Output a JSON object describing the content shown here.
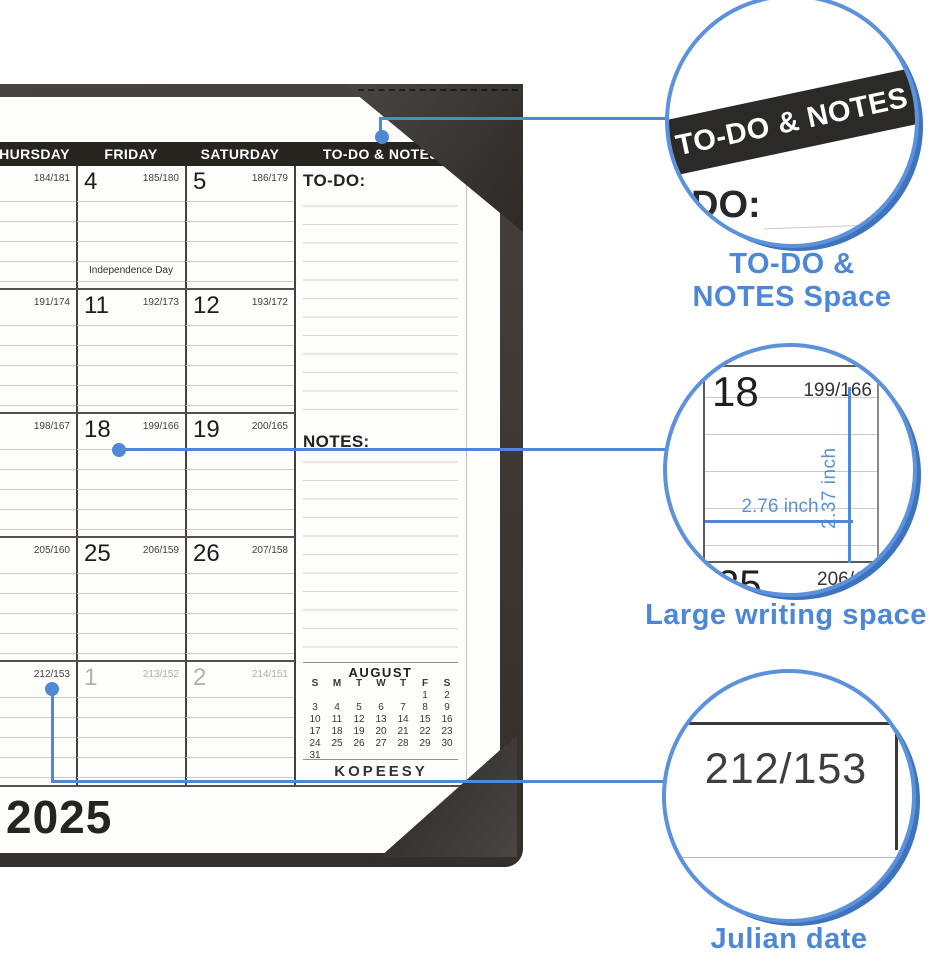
{
  "brand_calendar": {
    "weekdays": [
      "THURSDAY",
      "FRIDAY",
      "SATURDAY"
    ],
    "todo_col_header": "TO-DO & NOTES",
    "todo_label": "TO-DO:",
    "notes_label": "NOTES:",
    "holiday_note": "Independence Day",
    "rows": [
      {
        "thu_julian": "184/181",
        "fri_date": "4",
        "fri_julian": "185/180",
        "sat_date": "5",
        "sat_julian": "186/179"
      },
      {
        "thu_julian": "191/174",
        "fri_date": "11",
        "fri_julian": "192/173",
        "sat_date": "12",
        "sat_julian": "193/172"
      },
      {
        "thu_julian": "198/167",
        "fri_date": "18",
        "fri_julian": "199/166",
        "sat_date": "19",
        "sat_julian": "200/165"
      },
      {
        "thu_julian": "205/160",
        "fri_date": "25",
        "fri_julian": "206/159",
        "sat_date": "26",
        "sat_julian": "207/158"
      },
      {
        "thu_julian": "212/153",
        "fri_date": "1",
        "fri_julian": "213/152",
        "sat_date": "2",
        "sat_julian": "214/151"
      }
    ],
    "mini_month": {
      "title": "AUGUST",
      "day_headers": [
        "S",
        "M",
        "T",
        "W",
        "T",
        "F",
        "S"
      ],
      "weeks": [
        [
          "",
          "",
          "",
          "",
          "",
          "1",
          "2"
        ],
        [
          "3",
          "4",
          "5",
          "6",
          "7",
          "8",
          "9"
        ],
        [
          "10",
          "11",
          "12",
          "13",
          "14",
          "15",
          "16"
        ],
        [
          "17",
          "18",
          "19",
          "20",
          "21",
          "22",
          "23"
        ],
        [
          "24",
          "25",
          "26",
          "27",
          "28",
          "29",
          "30"
        ],
        [
          "31",
          "",
          "",
          "",
          "",
          "",
          ""
        ]
      ]
    },
    "brand": "KOPEESY",
    "year": "2025"
  },
  "callouts": {
    "todo": {
      "banner": "TO-DO & NOTES",
      "partial_text": "DO:",
      "caption_line1": "TO-DO &",
      "caption_line2": "NOTES Space"
    },
    "writing": {
      "caption": "Large writing space",
      "cell_date": "18",
      "cell_julian": "199/166",
      "width_label": "2.76 inch",
      "height_label": "2.37 inch",
      "next_date": "25",
      "next_julian": "206/159"
    },
    "julian": {
      "caption": "Julian date",
      "value": "212/153"
    }
  },
  "colors": {
    "accent_blue": "#4f89d5",
    "caption_blue": "#4d87d8",
    "header_bar": "#282420",
    "leather": "#3f3b38"
  }
}
